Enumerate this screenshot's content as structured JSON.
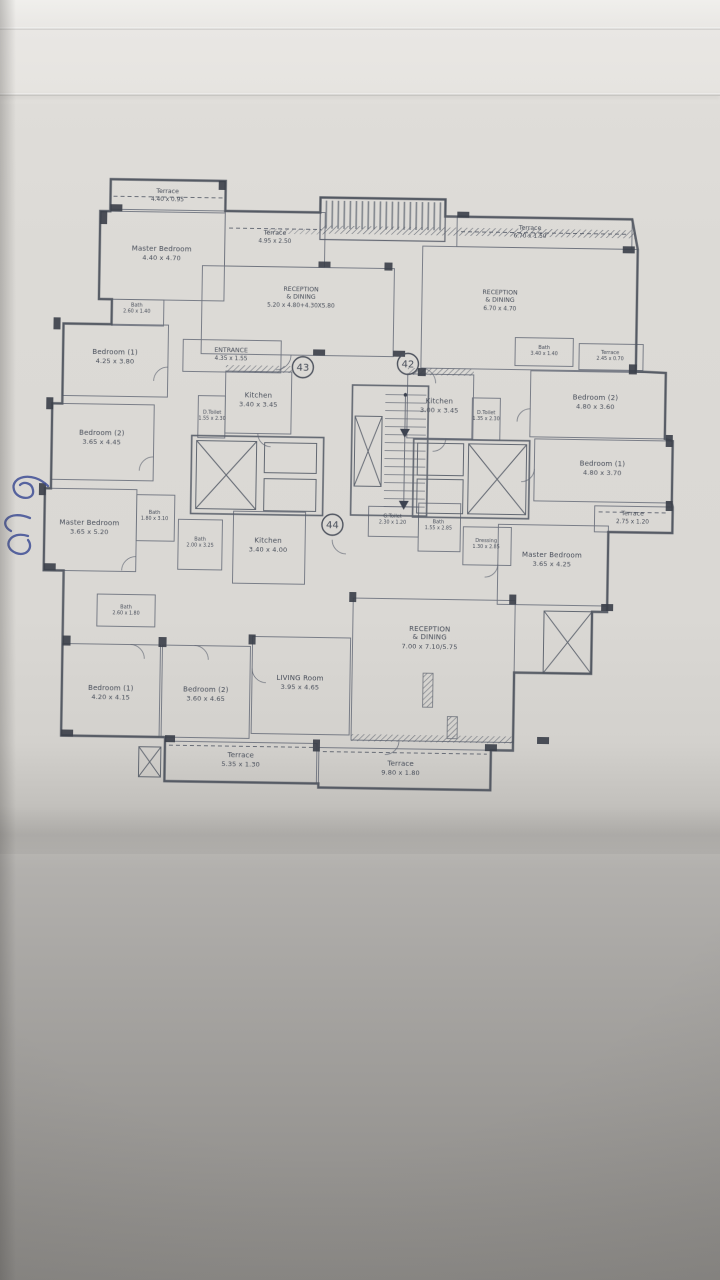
{
  "plan": {
    "units": [
      "43",
      "42",
      "44"
    ],
    "rooms": [
      {
        "name": "Terrace",
        "dims": "4.40 x 0.95"
      },
      {
        "name": "Master Bedroom",
        "dims": "4.40 x 4.70"
      },
      {
        "name": "Terrace",
        "dims": "4.95 x 2.50"
      },
      {
        "name": "RECEPTION",
        "name2": "& DINING",
        "dims": "5.20 x 4.80+4.30X5.80"
      },
      {
        "name": "Bath",
        "dims": "2.60 x 1.40"
      },
      {
        "name": "Bedroom (1)",
        "dims": "4.25 x 3.80"
      },
      {
        "name": "ENTRANCE",
        "dims": "4.35 x 1.55"
      },
      {
        "name": "Bedroom (2)",
        "dims": "3.65 x 4.45"
      },
      {
        "name": "Kitchen",
        "dims": "3.40 x 3.45"
      },
      {
        "name": "D.Toilet",
        "dims": "1.55 x 2.30"
      },
      {
        "name": "Bath",
        "dims": "1.80 x 3.10"
      },
      {
        "name": "Master Bedroom",
        "dims": "3.65 x 5.20"
      },
      {
        "name": "Bath",
        "dims": "2.00 x 3.25"
      },
      {
        "name": "Terrace",
        "dims": "6.70 x 1.50"
      },
      {
        "name": "RECEPTION",
        "name2": "& DINING",
        "dims": "6.70 x 4.70"
      },
      {
        "name": "Bath",
        "dims": "3.40 x 1.40"
      },
      {
        "name": "Terrace",
        "dims": "2.45 x 0.70"
      },
      {
        "name": "Bedroom (2)",
        "dims": "4.80 x 3.60"
      },
      {
        "name": "Kitchen",
        "dims": "3.00 x 3.45"
      },
      {
        "name": "D.Toilet",
        "dims": "1.35 x 2.30"
      },
      {
        "name": "Bedroom (1)",
        "dims": "4.80 x 3.70"
      },
      {
        "name": "Terrace",
        "dims": "2.75 x 1.20"
      },
      {
        "name": "Bath",
        "dims": "1.55 x 2.85"
      },
      {
        "name": "Dressing",
        "dims": "1.30 x 2.85"
      },
      {
        "name": "Master Bedroom",
        "dims": "3.65 x 4.25"
      },
      {
        "name": "G.Toilet",
        "dims": "2.30 x 1.20"
      },
      {
        "name": "Kitchen",
        "dims": "3.40 x 4.00"
      },
      {
        "name": "Bath",
        "dims": "2.60 x 1.80"
      },
      {
        "name": "Bedroom (1)",
        "dims": "4.20 x 4.15"
      },
      {
        "name": "Bedroom (2)",
        "dims": "3.60 x 4.65"
      },
      {
        "name": "LIVING Room",
        "dims": "3.95 x 4.65"
      },
      {
        "name": "RECEPTION",
        "name2": "& DINING",
        "dims": "7.00 x 7.10/5.75"
      },
      {
        "name": "Terrace",
        "dims": "5.35 x 1.30"
      },
      {
        "name": "Terrace",
        "dims": "9.80 x 1.80"
      }
    ],
    "colors": {
      "paper": "#dcdad6",
      "drawing_line": "#565c68",
      "handwriting_ink": "#3f4f96"
    }
  }
}
